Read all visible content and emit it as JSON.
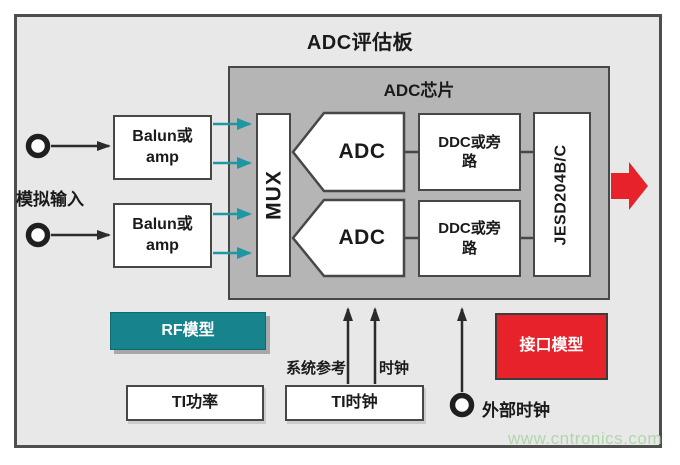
{
  "colors": {
    "board_bg": "#e8e8e8",
    "chip_bg": "#b5b5b5",
    "line": "#474747",
    "teal": "#17838d",
    "teal_arrow": "#1f97a3",
    "red": "#e8222b",
    "text": "#1a1a1a",
    "watermark": "#afd7aa"
  },
  "board": {
    "title": "ADC评估板"
  },
  "chip": {
    "label": "ADC芯片",
    "mux": "MUX",
    "adc_top": "ADC",
    "adc_bottom": "ADC",
    "ddc_top": {
      "line1": "DDC或旁",
      "line2": "路"
    },
    "ddc_bottom": {
      "line1": "DDC或旁",
      "line2": "路"
    },
    "jesd": "JESD204B/C"
  },
  "inputs": {
    "analog_label": "模拟输入",
    "balun_top": {
      "line1": "Balun或",
      "line2": "amp"
    },
    "balun_bottom": {
      "line1": "Balun或",
      "line2": "amp"
    }
  },
  "models": {
    "rf": "RF模型",
    "interface": "接口模型"
  },
  "bottom": {
    "ti_power": "TI功率",
    "ti_clock": "TI时钟",
    "sysref_label": "系统参考",
    "clock_label": "时钟",
    "ext_clock_label": "外部时钟"
  },
  "watermark": "www.cntronics.com"
}
